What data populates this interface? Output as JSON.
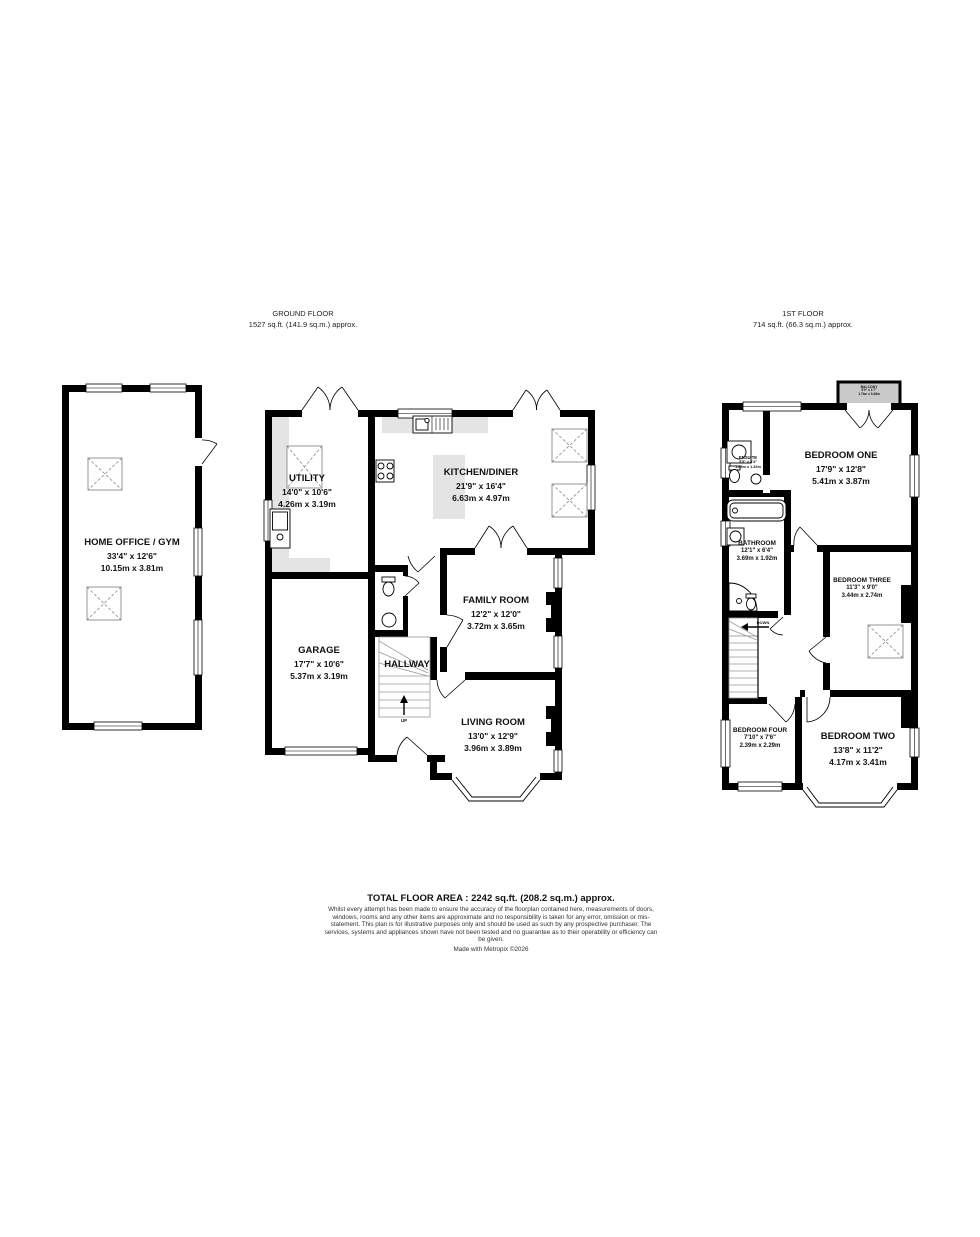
{
  "colors": {
    "wall": "#000000",
    "counter_fill": "#e4e4e4",
    "balcony_fill": "#c9c9c9",
    "text": "#1a1a1a"
  },
  "headers": {
    "ground": {
      "title": "GROUND FLOOR",
      "area": "1527 sq.ft. (141.9 sq.m.) approx."
    },
    "first": {
      "title": "1ST FLOOR",
      "area": "714 sq.ft. (66.3 sq.m.) approx."
    }
  },
  "rooms": {
    "home_office": {
      "name": "HOME OFFICE / GYM",
      "imperial": "33'4\" x 12'6\"",
      "metric": "10.15m x 3.81m"
    },
    "utility": {
      "name": "UTILITY",
      "imperial": "14'0\" x 10'6\"",
      "metric": "4.26m x 3.19m"
    },
    "kitchen_diner": {
      "name": "KITCHEN/DINER",
      "imperial": "21'9\" x 16'4\"",
      "metric": "6.63m x 4.97m"
    },
    "family_room": {
      "name": "FAMILY ROOM",
      "imperial": "12'2\" x 12'0\"",
      "metric": "3.72m x 3.65m"
    },
    "garage": {
      "name": "GARAGE",
      "imperial": "17'7\" x 10'6\"",
      "metric": "5.37m x 3.19m"
    },
    "hallway": {
      "name": "HALLWAY"
    },
    "living_room": {
      "name": "LIVING ROOM",
      "imperial": "13'0\" x 12'9\"",
      "metric": "3.96m x 3.89m"
    },
    "balcony": {
      "name": "BALCONY",
      "imperial": "5'9\" x 1'7\"",
      "metric": "1.74m x 0.48m"
    },
    "bedroom_one": {
      "name": "BEDROOM ONE",
      "imperial": "17'9\" x 12'8\"",
      "metric": "5.41m x 3.87m"
    },
    "ensuite": {
      "name": "ENSUITE",
      "imperial": "5'5\" x 4'4\"",
      "metric": "1.65m x 1.32m"
    },
    "bathroom": {
      "name": "BATHROOM",
      "imperial": "12'1\" x 6'4\"",
      "metric": "3.69m x 1.92m"
    },
    "bedroom_three": {
      "name": "BEDROOM THREE",
      "imperial": "11'3\" x 9'0\"",
      "metric": "3.44m x 2.74m"
    },
    "bedroom_four": {
      "name": "BEDROOM FOUR",
      "imperial": "7'10\" x 7'6\"",
      "metric": "2.39m x 2.29m"
    },
    "bedroom_two": {
      "name": "BEDROOM TWO",
      "imperial": "13'8\" x 11'2\"",
      "metric": "4.17m x 3.41m"
    }
  },
  "stairs": {
    "up": "UP",
    "down": "DOWN"
  },
  "footer": {
    "total_area": "TOTAL FLOOR AREA : 2242 sq.ft. (208.2 sq.m.) approx.",
    "disclaimer": "Whilst every attempt has been made to ensure the accuracy of the floorplan contained here, measurements of doors, windows, rooms and any other items are approximate and no responsibility is taken for any error, omission or mis-statement. This plan is for illustrative purposes only and should be used as such by any prospective purchaser. The services, systems and appliances shown have not been tested and no guarantee as to their operability or efficiency can be given.",
    "credit": "Made with Metropix ©2026"
  }
}
